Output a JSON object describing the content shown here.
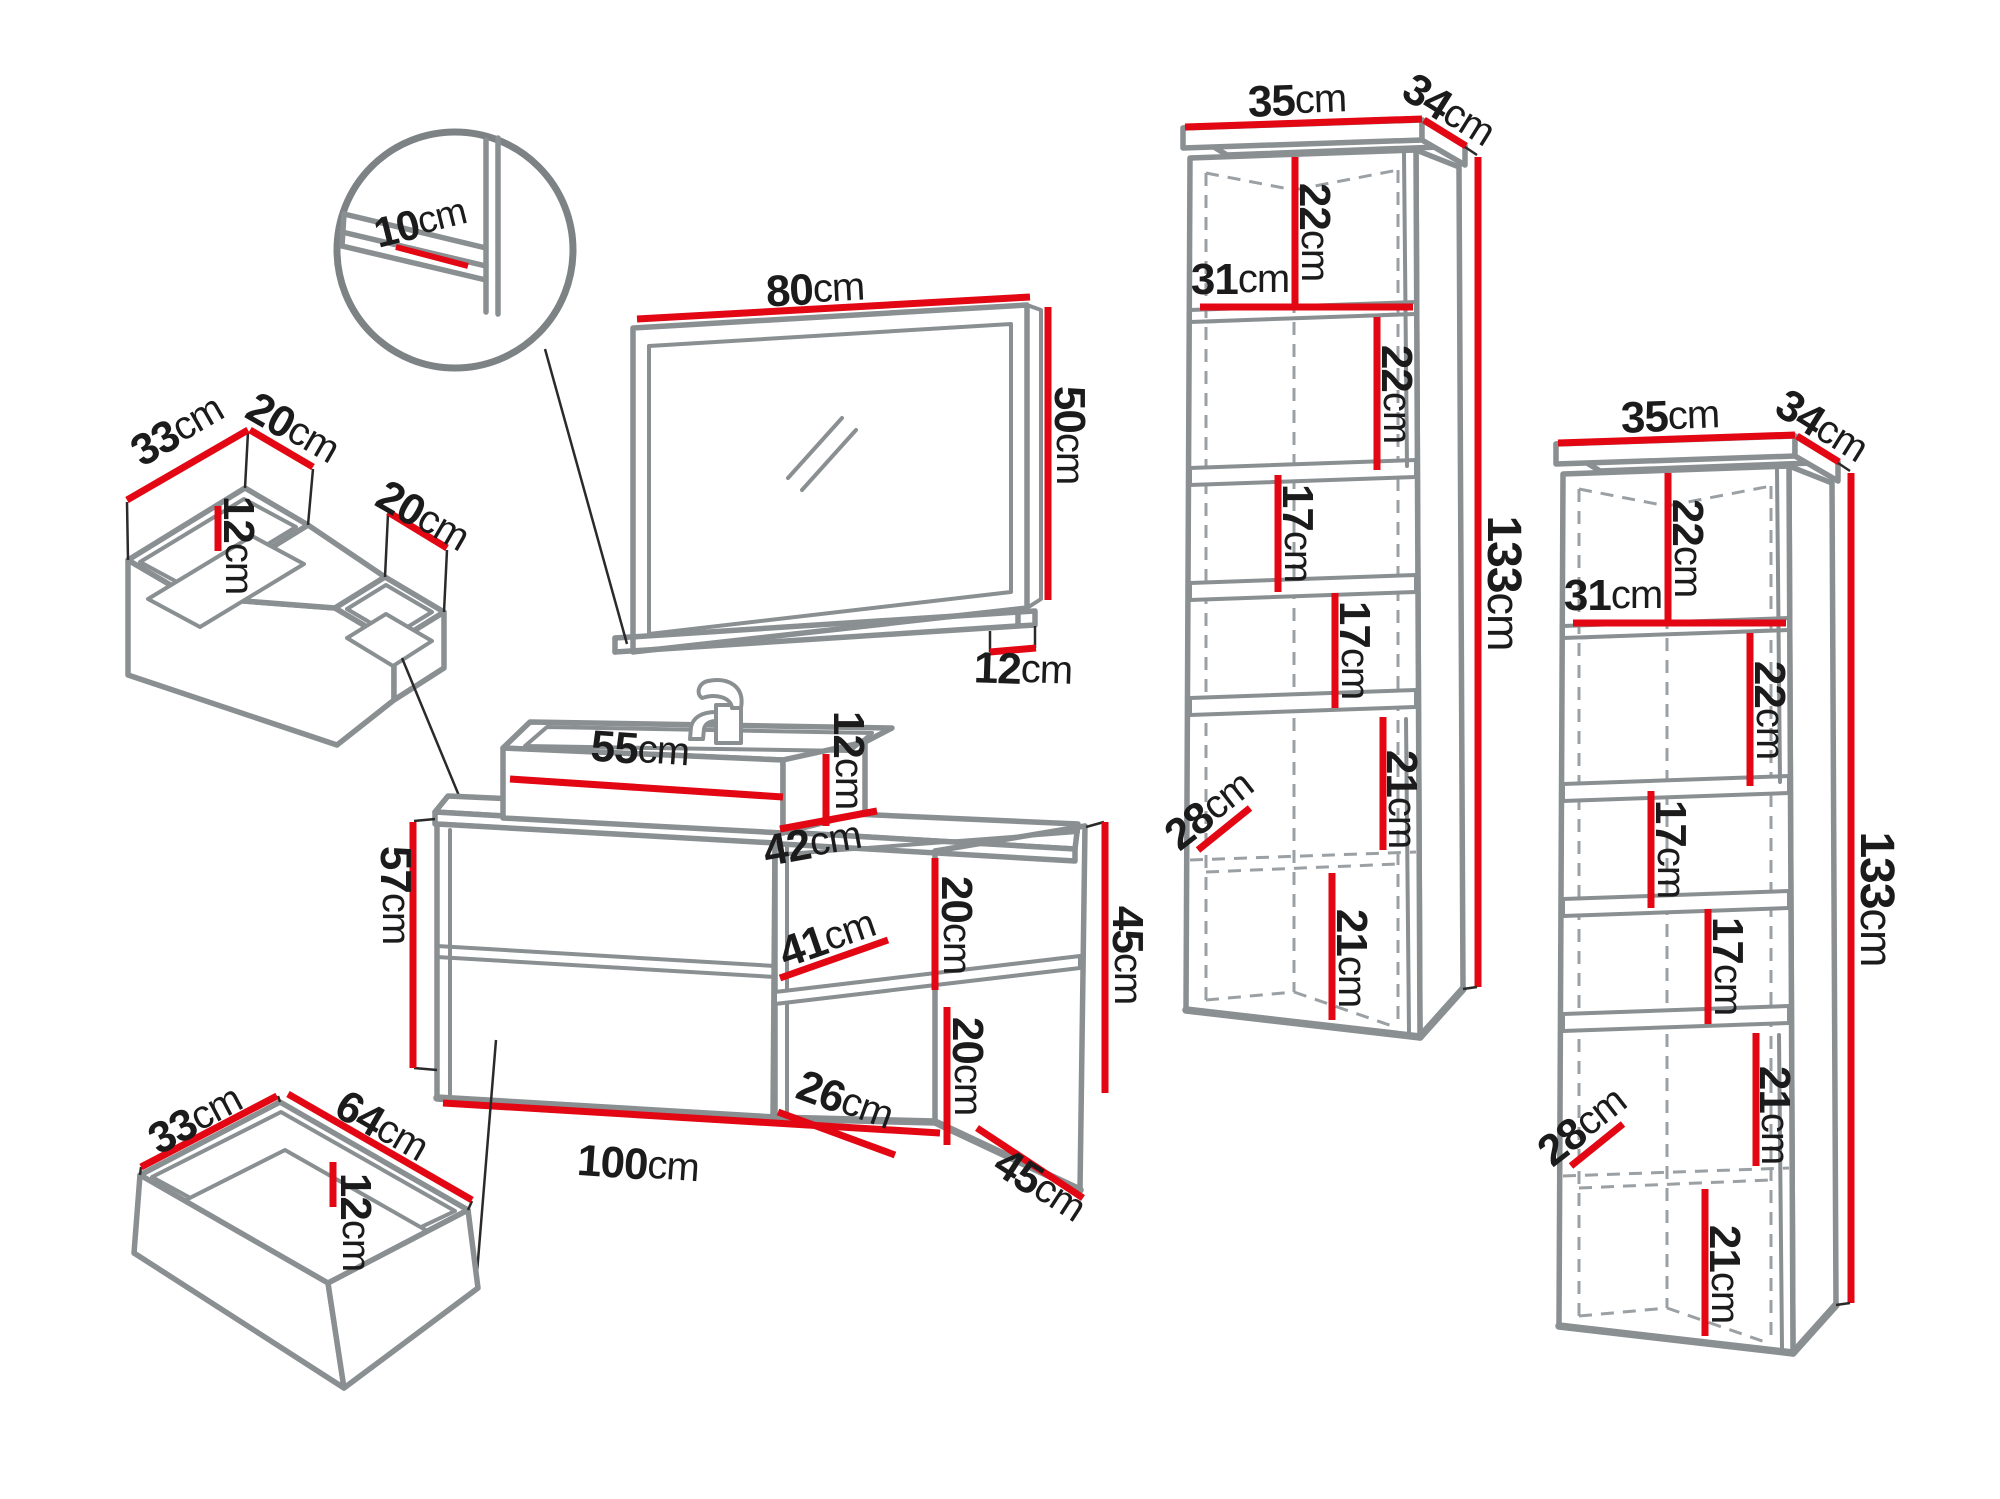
{
  "unit": "cm",
  "colors": {
    "dimension_line": "#e30613",
    "furniture_line": "#8a8f92",
    "label_text": "#1b1b1b"
  },
  "pieces": {
    "shelf_detail": {
      "shelf_depth": "10"
    },
    "drawer_organizer": {
      "depth": "33",
      "left_width": "20",
      "height": "12",
      "right_width": "20"
    },
    "mirror": {
      "width": "80",
      "height": "50",
      "shelf_depth": "12"
    },
    "washbasin": {
      "width": "55",
      "height": "12",
      "depth": "42"
    },
    "vanity": {
      "height": "57",
      "width": "100",
      "depth": "45",
      "open_height": "45",
      "open_shelf_width": "41",
      "open_top_height": "20",
      "open_bottom_height": "20",
      "open_bottom_width": "26"
    },
    "drawer": {
      "depth": "33",
      "width": "64",
      "height": "12"
    },
    "tall_cabinet_left": {
      "top_width": "35",
      "top_depth": "34",
      "section_a": "22",
      "shelf_width": "31",
      "section_b": "22",
      "section_c": "17",
      "section_d": "17",
      "section_e": "21",
      "section_f": "21",
      "interior_width": "28",
      "height": "133"
    },
    "tall_cabinet_right": {
      "top_width": "35",
      "top_depth": "34",
      "section_a": "22",
      "shelf_width": "31",
      "section_b": "22",
      "section_c": "17",
      "section_d": "17",
      "section_e": "21",
      "section_f": "21",
      "interior_width": "28",
      "height": "133"
    }
  }
}
